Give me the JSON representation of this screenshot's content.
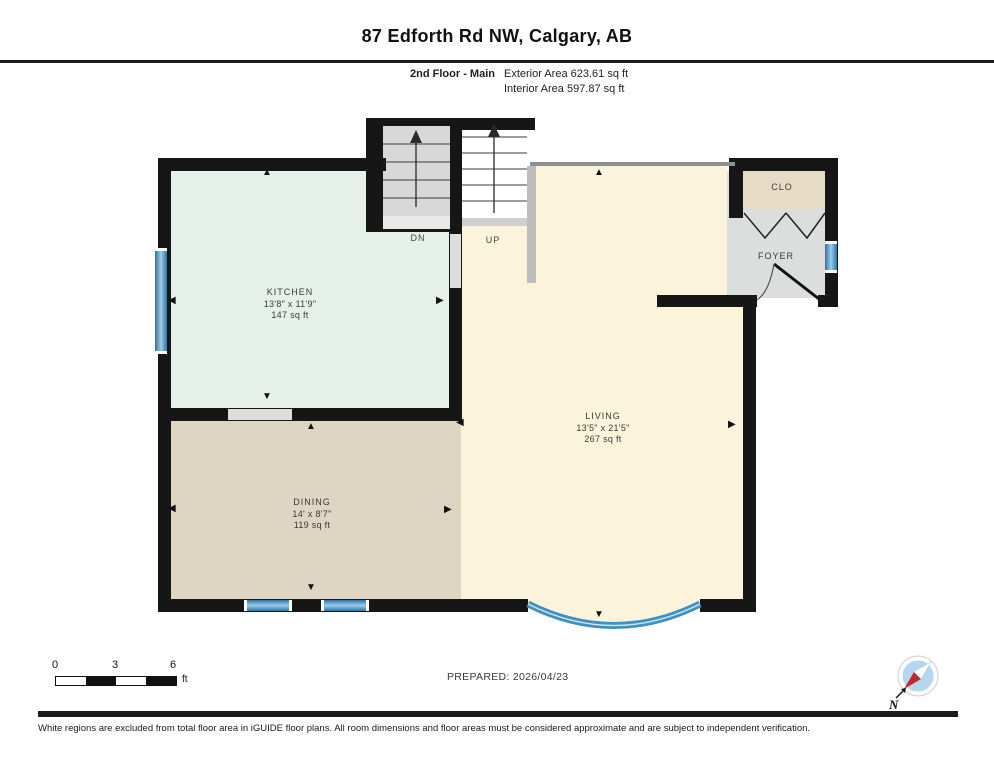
{
  "header": {
    "title": "87 Edforth Rd NW, Calgary, AB",
    "floor_label": "2nd Floor - Main",
    "exterior_area": "Exterior Area 623.61 sq ft",
    "interior_area": "Interior Area 597.87 sq ft"
  },
  "rooms": {
    "kitchen": {
      "name": "KITCHEN",
      "dims": "13'8\" x 11'9\"",
      "area": "147 sq ft"
    },
    "dining": {
      "name": "DINING",
      "dims": "14' x 8'7\"",
      "area": "119 sq ft"
    },
    "living": {
      "name": "LIVING",
      "dims": "13'5\" x 21'5\"",
      "area": "267 sq ft"
    },
    "foyer": {
      "name": "FOYER"
    },
    "closet": {
      "name": "CLO"
    }
  },
  "stairs": {
    "down_label": "DN",
    "up_label": "UP"
  },
  "icons": {
    "dim_up": "▲",
    "dim_down": "▼",
    "dim_left": "◀",
    "dim_right": "▶"
  },
  "scale_bar": {
    "tick0": "0",
    "tick1": "3",
    "tick2": "6",
    "unit": "ft"
  },
  "compass": {
    "north_label": "N"
  },
  "footer": {
    "prepared": "PREPARED: 2026/04/23",
    "disclaimer": "White regions are excluded from total floor area in iGUIDE floor plans. All room dimensions and floor areas must be considered approximate and are subject to independent verification."
  },
  "colors": {
    "wall": "#161616",
    "kitchen_floor": "#e5f0e9",
    "dining_floor": "#ded5c2",
    "living_floor": "#fbf4db",
    "foyer_floor": "#dcdddd",
    "closet_floor": "#e6dcc6",
    "window_blue": "#4f97c6",
    "stair_gray": "#d8d8d8"
  }
}
